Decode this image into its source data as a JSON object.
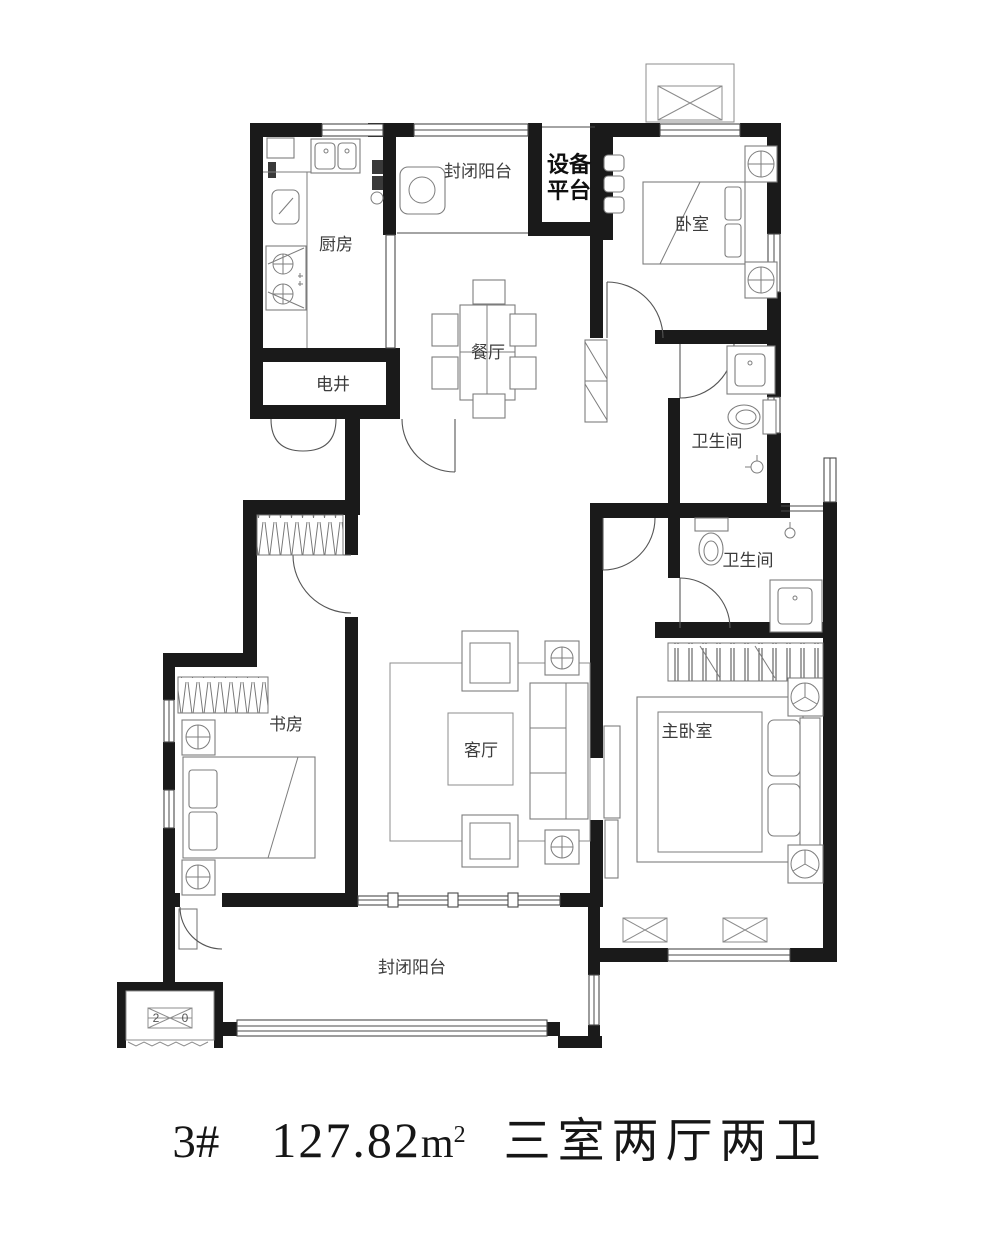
{
  "plan": {
    "rooms": {
      "kitchen": "厨房",
      "balcony_top": "封闭阳台",
      "equipment_line1": "设备",
      "equipment_line2": "平台",
      "bedroom": "卧室",
      "dining": "餐厅",
      "shaft": "电井",
      "bath_upper": "卫生间",
      "bath_lower": "卫生间",
      "study": "书房",
      "living": "客厅",
      "master_bedroom": "主卧室",
      "balcony_bottom": "封闭阳台"
    },
    "ac_marker": {
      "left": "2",
      "right": "0"
    }
  },
  "footer": {
    "unit_number": "3#",
    "area_value": "127.82",
    "area_unit_base": "m",
    "area_unit_exponent": "2",
    "layout_type": "三室两厅两卫"
  },
  "colors": {
    "wall": "#1a1a1a",
    "furniture_line": "#7d7d7d",
    "label_text": "#3c3c3c"
  }
}
